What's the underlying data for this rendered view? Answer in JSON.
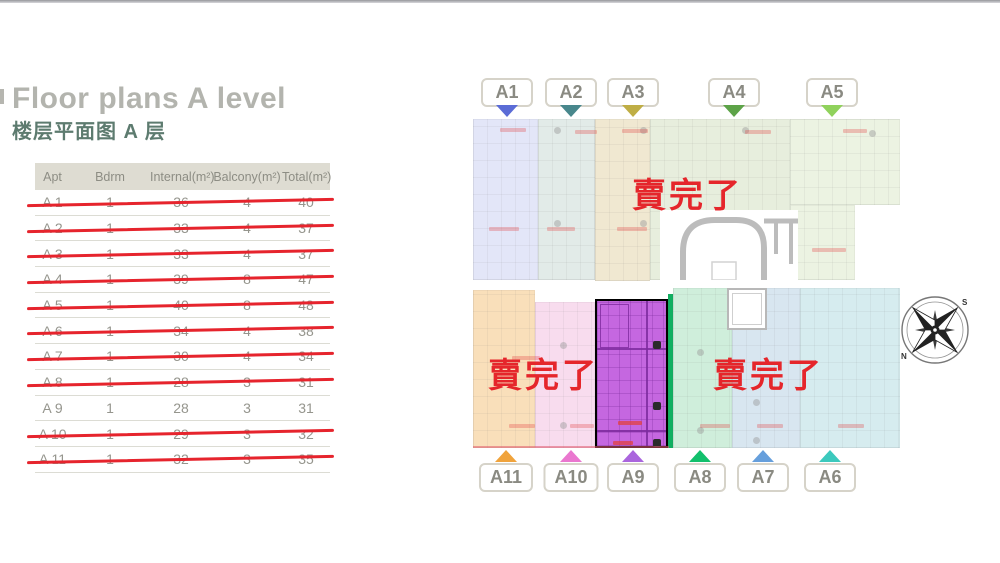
{
  "header": {
    "title": "Floor plans A level",
    "subtitle": "楼层平面图 A 层"
  },
  "table": {
    "columns": [
      "Apt",
      "Bdrm",
      "Internal(m²)",
      "Balcony(m²)",
      "Total(m²)"
    ],
    "rows": [
      {
        "apt": "A 1",
        "bdrm": "1",
        "internal": "36",
        "balcony": "4",
        "total": "40",
        "status": "sold"
      },
      {
        "apt": "A 2",
        "bdrm": "1",
        "internal": "33",
        "balcony": "4",
        "total": "37",
        "status": "sold"
      },
      {
        "apt": "A 3",
        "bdrm": "1",
        "internal": "33",
        "balcony": "4",
        "total": "37",
        "status": "sold"
      },
      {
        "apt": "A 4",
        "bdrm": "1",
        "internal": "39",
        "balcony": "8",
        "total": "47",
        "status": "sold"
      },
      {
        "apt": "A 5",
        "bdrm": "1",
        "internal": "40",
        "balcony": "8",
        "total": "48",
        "status": "sold"
      },
      {
        "apt": "A 6",
        "bdrm": "1",
        "internal": "34",
        "balcony": "4",
        "total": "38",
        "status": "sold"
      },
      {
        "apt": "A 7",
        "bdrm": "1",
        "internal": "30",
        "balcony": "4",
        "total": "34",
        "status": "sold"
      },
      {
        "apt": "A 8",
        "bdrm": "1",
        "internal": "28",
        "balcony": "3",
        "total": "31",
        "status": "sold"
      },
      {
        "apt": "A 9",
        "bdrm": "1",
        "internal": "28",
        "balcony": "3",
        "total": "31",
        "status": "available"
      },
      {
        "apt": "A 10",
        "bdrm": "1",
        "internal": "29",
        "balcony": "3",
        "total": "32",
        "status": "sold"
      },
      {
        "apt": "A 11",
        "bdrm": "1",
        "internal": "32",
        "balcony": "3",
        "total": "35",
        "status": "sold"
      }
    ],
    "strike_color": "#e6242d"
  },
  "plan": {
    "sold_out_text": "賣完了",
    "sold_out_color": "#e5262b",
    "top_labels": [
      {
        "label": "A1",
        "color": "#5b6cd6"
      },
      {
        "label": "A2",
        "color": "#48878c"
      },
      {
        "label": "A3",
        "color": "#bfae45"
      },
      {
        "label": "A4",
        "color": "#5da348"
      },
      {
        "label": "A5",
        "color": "#90d25c"
      }
    ],
    "bottom_labels": [
      {
        "label": "A11",
        "color": "#f0a33c"
      },
      {
        "label": "A10",
        "color": "#ea77cf"
      },
      {
        "label": "A9",
        "color": "#aa65dd"
      },
      {
        "label": "A8",
        "color": "#12c06c"
      },
      {
        "label": "A7",
        "color": "#669fdc"
      },
      {
        "label": "A6",
        "color": "#3cc9bd"
      }
    ],
    "zones": {
      "a1": "#e3e6f8",
      "a2": "#e2ebe8",
      "a3": "#f0e8d1",
      "a4": "#e7eedd",
      "a5": "#ecf3e2",
      "a11": "#f9dfba",
      "a10": "#f8dcee",
      "a9": "#c567e0",
      "a9_outline": "#7d2b9e",
      "a9_divider": "#10b061",
      "a8": "#cfeedb",
      "a7": "#d8e6f0",
      "a6": "#d6ecef"
    },
    "compass": {
      "north": "N",
      "south": "S"
    }
  }
}
